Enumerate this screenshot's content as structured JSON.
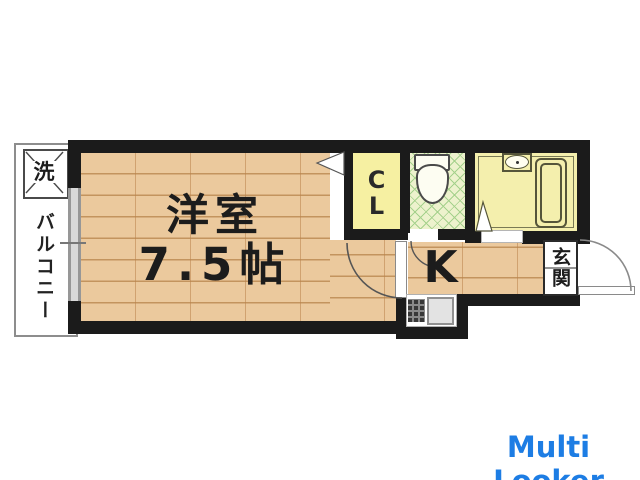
{
  "floor_plan": {
    "balcony": {
      "label": "バルコニー",
      "washer_label": "洗"
    },
    "living_room": {
      "name": "洋室",
      "size": "7.5帖"
    },
    "closet": {
      "label_line1": "C",
      "label_line2": "L"
    },
    "kitchen": {
      "label": "K"
    },
    "entrance": {
      "label": "玄関"
    },
    "fixture_icons": [
      "washing-machine-icon",
      "toilet-icon",
      "wash-basin-icon",
      "bathtub-icon",
      "shower-icon",
      "gas-stove-icon",
      "kitchen-sink-icon"
    ],
    "colors": {
      "wall": "#1b1b1b",
      "wood_floor": "#ebc99d",
      "floor_line": "#c3945e",
      "closet_fill": "#f6f0a2",
      "toilet_floor": "#edf2cd",
      "toilet_lattice": "#a5d18c",
      "bathroom_fill": "#f4efad",
      "sink_gray": "#e3e3e3",
      "watermark_blue": "#1d7de4"
    }
  },
  "watermark": {
    "text": "Multi Looker"
  }
}
